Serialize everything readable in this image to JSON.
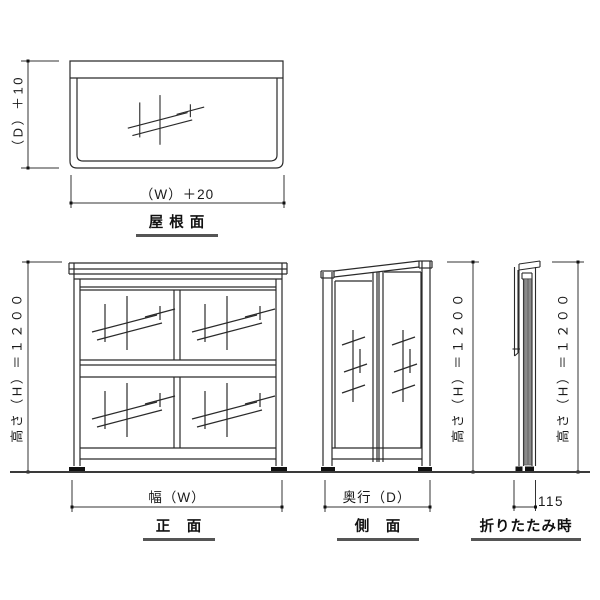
{
  "document": {
    "type": "technical-drawing",
    "background": "#ffffff",
    "line_color": "#2a2a2a",
    "underline_color": "#555555",
    "panel_gray": "#8a8a8a"
  },
  "views": {
    "roof": {
      "caption": "屋 根 面",
      "depth_dim": "（D）＋10",
      "width_dim": "（W）＋20"
    },
    "front": {
      "caption": "正　面",
      "height_dim": "高さ（H）＝１２００",
      "width_dim": "幅（W）"
    },
    "side": {
      "caption": "側　面",
      "height_dim": "高さ（H）＝１２００",
      "depth_dim": "奥行（D）"
    },
    "folded": {
      "caption": "折りたたみ時",
      "height_dim": "高さ（H）＝１２００",
      "width_dim": "115"
    }
  }
}
